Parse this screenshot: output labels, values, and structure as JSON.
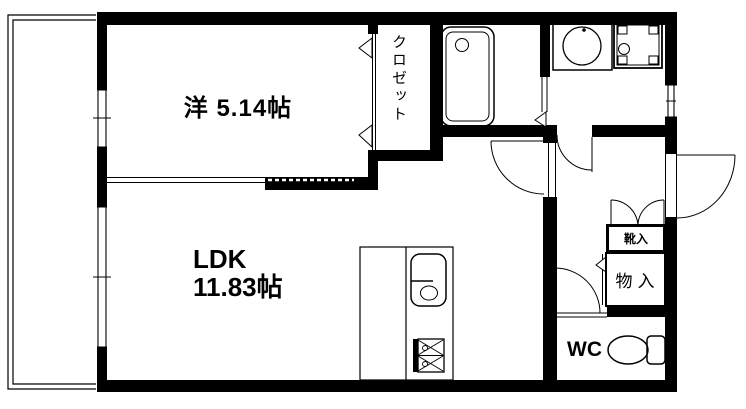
{
  "floor_plan": {
    "rooms": {
      "western_room": {
        "label": "洋 5.14帖"
      },
      "ldk": {
        "name": "LDK",
        "size": "11.83帖"
      },
      "closet": {
        "label": "クロゼット"
      },
      "shoe_cabinet": {
        "label": "靴入"
      },
      "storage": {
        "label": "物入"
      },
      "toilet_room": {
        "label": "WC"
      }
    },
    "fixtures": {
      "bathtub": "bathtub-icon",
      "washbasin": "washbasin-icon",
      "washing_machine_pan": "washing-machine-icon",
      "kitchen_sink": "kitchen-sink-icon",
      "stove": "stove-icon",
      "toilet": "toilet-icon"
    },
    "colors": {
      "wall": "#000000",
      "background": "#ffffff",
      "line": "#000000"
    }
  }
}
